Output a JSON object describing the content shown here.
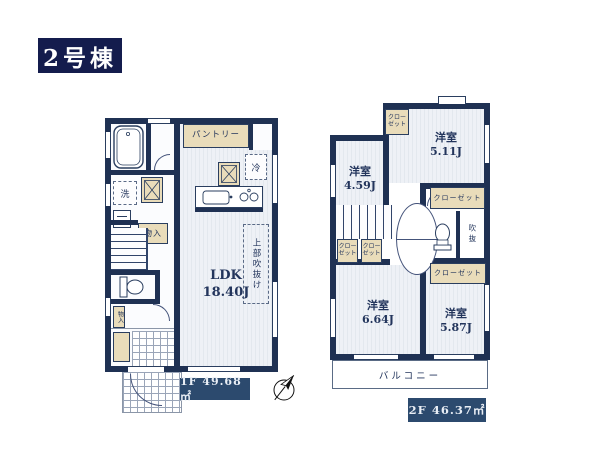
{
  "title": "2号棟",
  "colors": {
    "wall": "#1f3153",
    "title_bg": "#141c4d",
    "area_label_bg": "#2c4a6e",
    "beige": "#e9dcba",
    "floor_stripe": "#e3e8ee"
  },
  "floor1": {
    "area_label": "1F 49.68㎡",
    "ldk_label": "LDK\n18.40J",
    "pantry": "パントリー",
    "fridge": "冷",
    "washer": "洗",
    "storage_main": "物入",
    "storage_small": "物入",
    "upper_void": "上部吹抜け"
  },
  "floor2": {
    "area_label": "2F 46.37㎡",
    "room_nw": "洋室\n4.59J",
    "room_ne": "洋室\n5.11J",
    "room_sw": "洋室\n6.64J",
    "room_se": "洋室\n5.87J",
    "closet_ne": "クロー\nゼット",
    "closet_hall_a": "クロー\nゼット",
    "closet_hall_b": "クロー\nゼット",
    "closet_long_top": "クローゼット",
    "closet_long_bottom": "クローゼット",
    "void": "吹抜",
    "balcony": "バルコニー"
  }
}
